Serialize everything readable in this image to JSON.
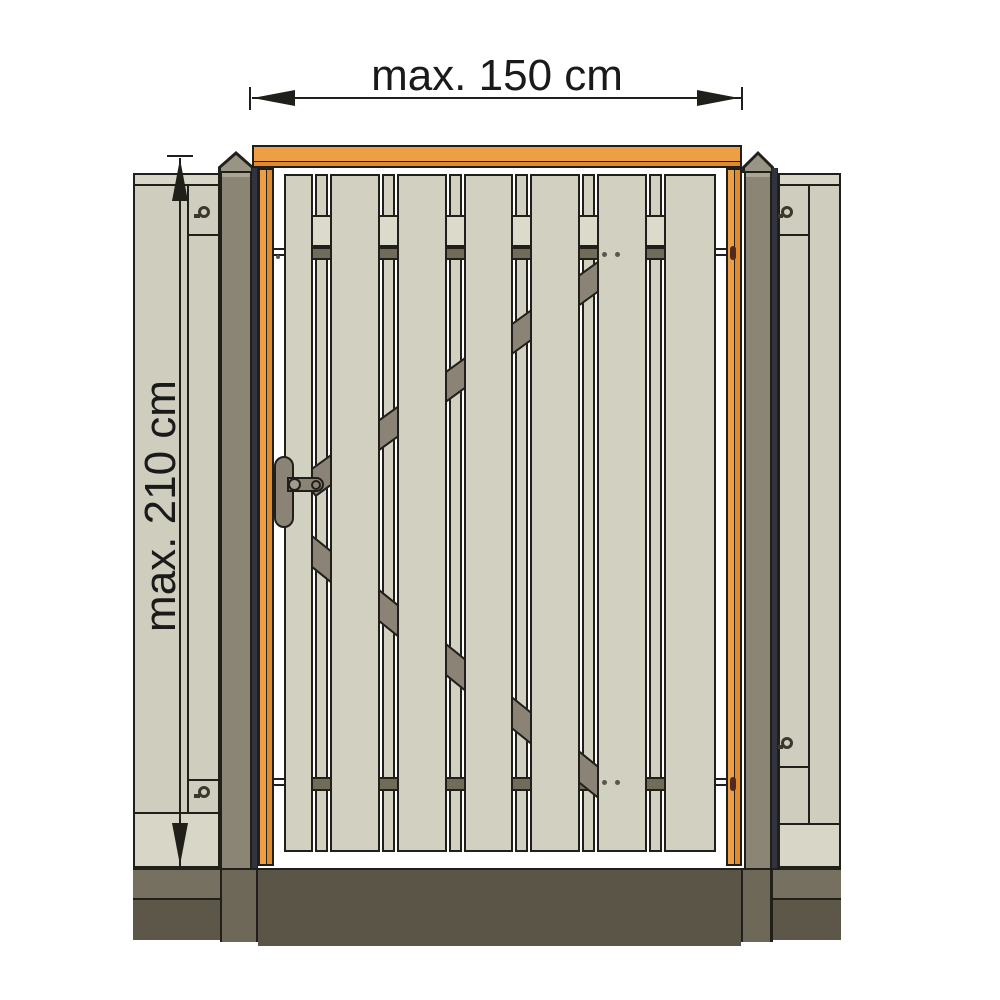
{
  "diagram": {
    "type": "technical-illustration",
    "subject": "wooden garden gate between two fence posts with side fence panels",
    "width_dimension_label": "max. 150 cm",
    "height_dimension_label": "max. 210 cm",
    "gate": {
      "front_plank_count": 7,
      "back_plank_count": 6,
      "ledge_count": 2,
      "brace_count": 2,
      "hinge_count": 2
    }
  },
  "colors": {
    "outline": "#201f1a",
    "beige": "#d2d0c1",
    "beige-light": "#dcdacb",
    "fence": "#cfcdbe",
    "fence-cap": "#d8d6c7",
    "orange": "#ee9f45",
    "orange-dark": "#dd8a30",
    "post": "#8b8575",
    "post-cap": "#9a9484",
    "post-shoulder": "#aaa492",
    "navy": "#31343f",
    "ledge-dark": "#716b59",
    "hw-gray": "#8b8476",
    "hw-light": "#a19b8b",
    "ground-center": "#5b5548",
    "ground-post": "#6e6859",
    "ground-side-top": "#767061",
    "ground-side-bottom": "#5d574a",
    "pin": "#53291e",
    "screw": "#3b372c",
    "dot": "#5c564a",
    "text": "#1a1a1a"
  }
}
